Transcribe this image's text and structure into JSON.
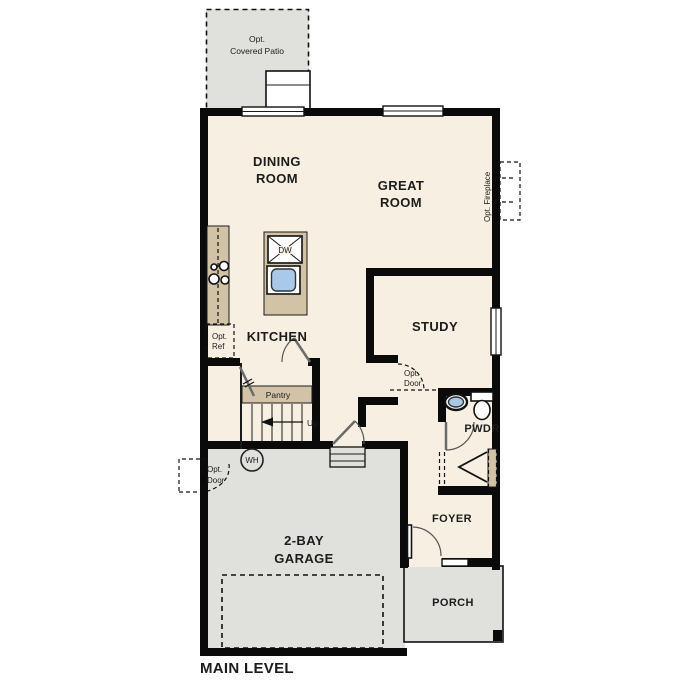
{
  "title": "MAIN LEVEL",
  "rooms": {
    "patio": [
      "Opt.",
      "Covered Patio"
    ],
    "dining": [
      "DINING",
      "ROOM"
    ],
    "great": [
      "GREAT",
      "ROOM"
    ],
    "kitchen": "KITCHEN",
    "study": "STUDY",
    "pantry": "Pantry",
    "powder": "PWDR",
    "garage": [
      "2-BAY",
      "GARAGE"
    ],
    "foyer": "FOYER",
    "porch": "PORCH"
  },
  "annotations": {
    "opt_fireplace": "Opt. Fireplace",
    "opt_ref": [
      "Opt.",
      "Ref"
    ],
    "opt_door_study": [
      "Opt.",
      "Door"
    ],
    "opt_door_garage": [
      "Opt.",
      "Door"
    ],
    "up": "Up",
    "dw": "DW",
    "wh": "WH"
  },
  "palette": {
    "floor_cream": "#f6efe2",
    "hardscape_gray": "#e0e0dd",
    "counter_tan": "#d2c3a6",
    "sink_blue": "#a9c9ea",
    "wall_black": "#0a0a0a"
  }
}
